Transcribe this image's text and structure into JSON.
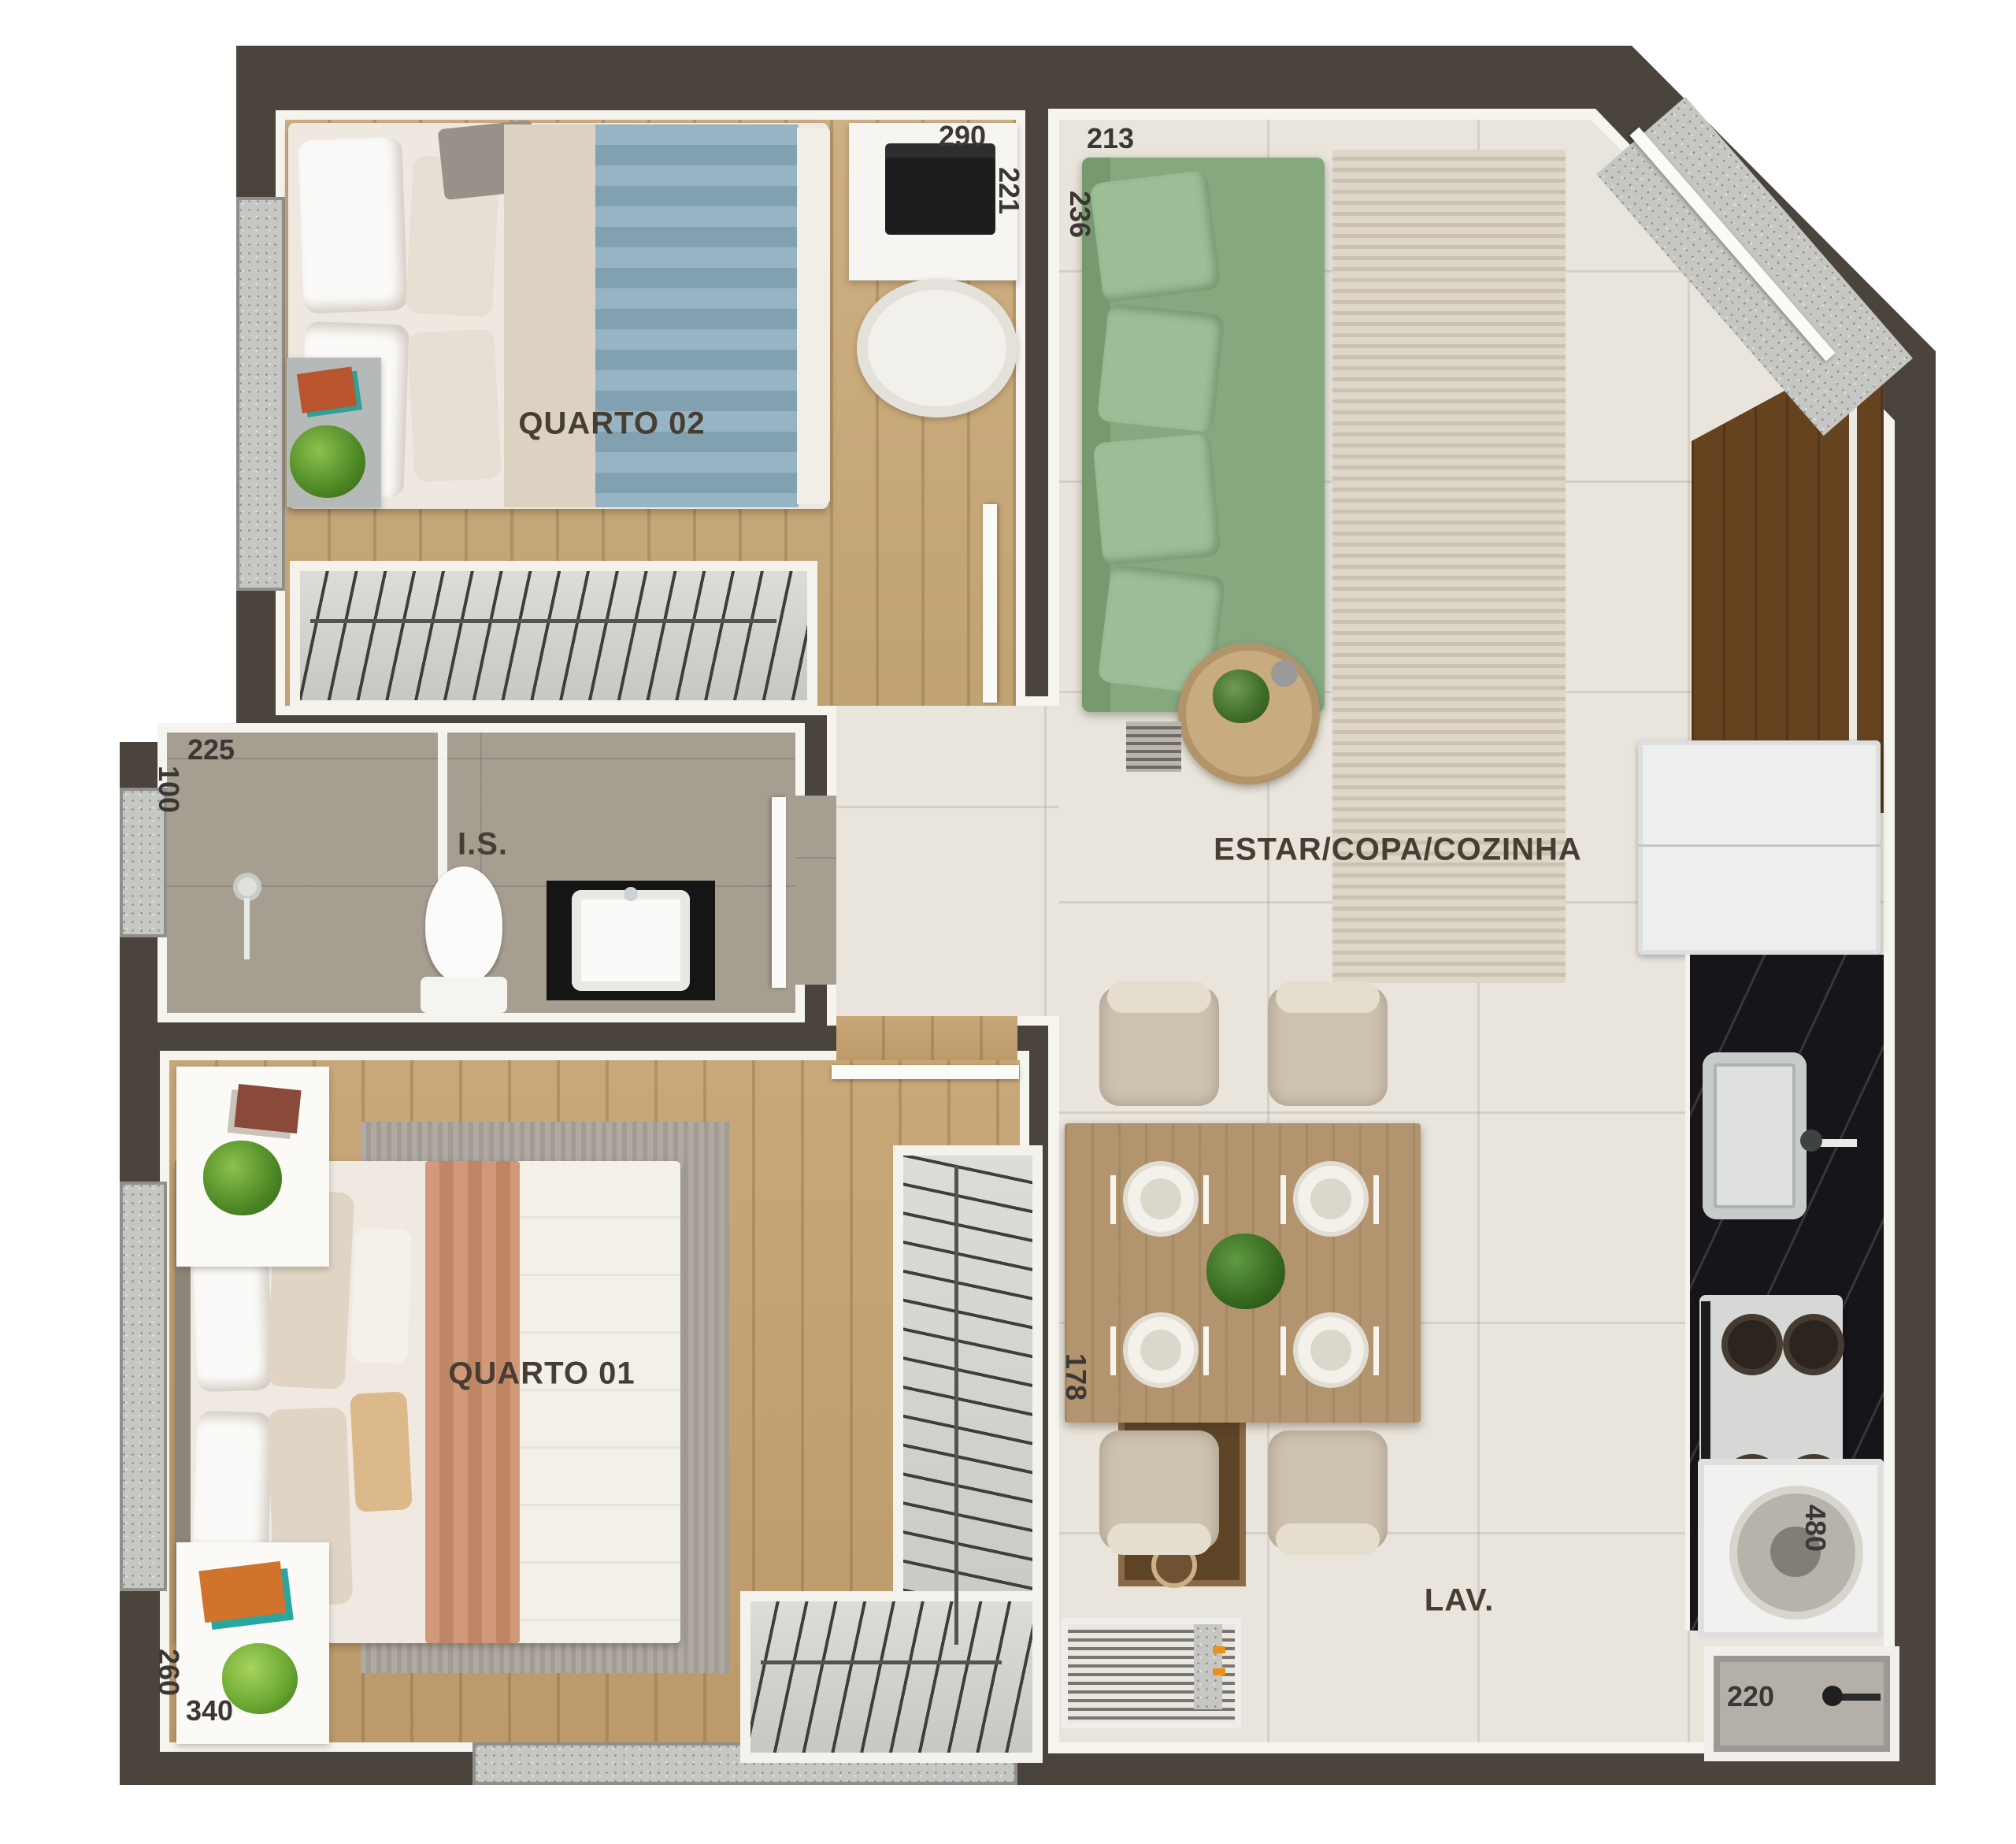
{
  "floorplan": {
    "room_labels": {
      "quarto02": "QUARTO 02",
      "quarto01": "QUARTO 01",
      "bathroom": "I.S.",
      "living": "ESTAR/COPA/COZINHA",
      "laundry": "LAV."
    },
    "dimensions": {
      "d290": "290",
      "d221": "221",
      "d213": "213",
      "d236": "236",
      "d225": "225",
      "d100": "100",
      "d178": "178",
      "d260": "260",
      "d340": "340",
      "d480": "480",
      "d220": "220"
    },
    "palette": {
      "wall": "#4a443c",
      "wall_edge": "#f6f4ef",
      "wood_floor": "#c9ab7e",
      "tile_living": "#e9e5dc",
      "tile_bath": "#a79e92",
      "granite": "#c6c7c3",
      "sofa_green": "#85a87f",
      "cushion_green": "#9cbd96",
      "blanket_blue": "#8cadbd",
      "blanket_terracotta": "#cc8d6b",
      "counter_black": "#17151a",
      "cabinet_wood": "#66431f",
      "dining_wood": "#b2956e",
      "label_text": "#3b3734"
    }
  }
}
